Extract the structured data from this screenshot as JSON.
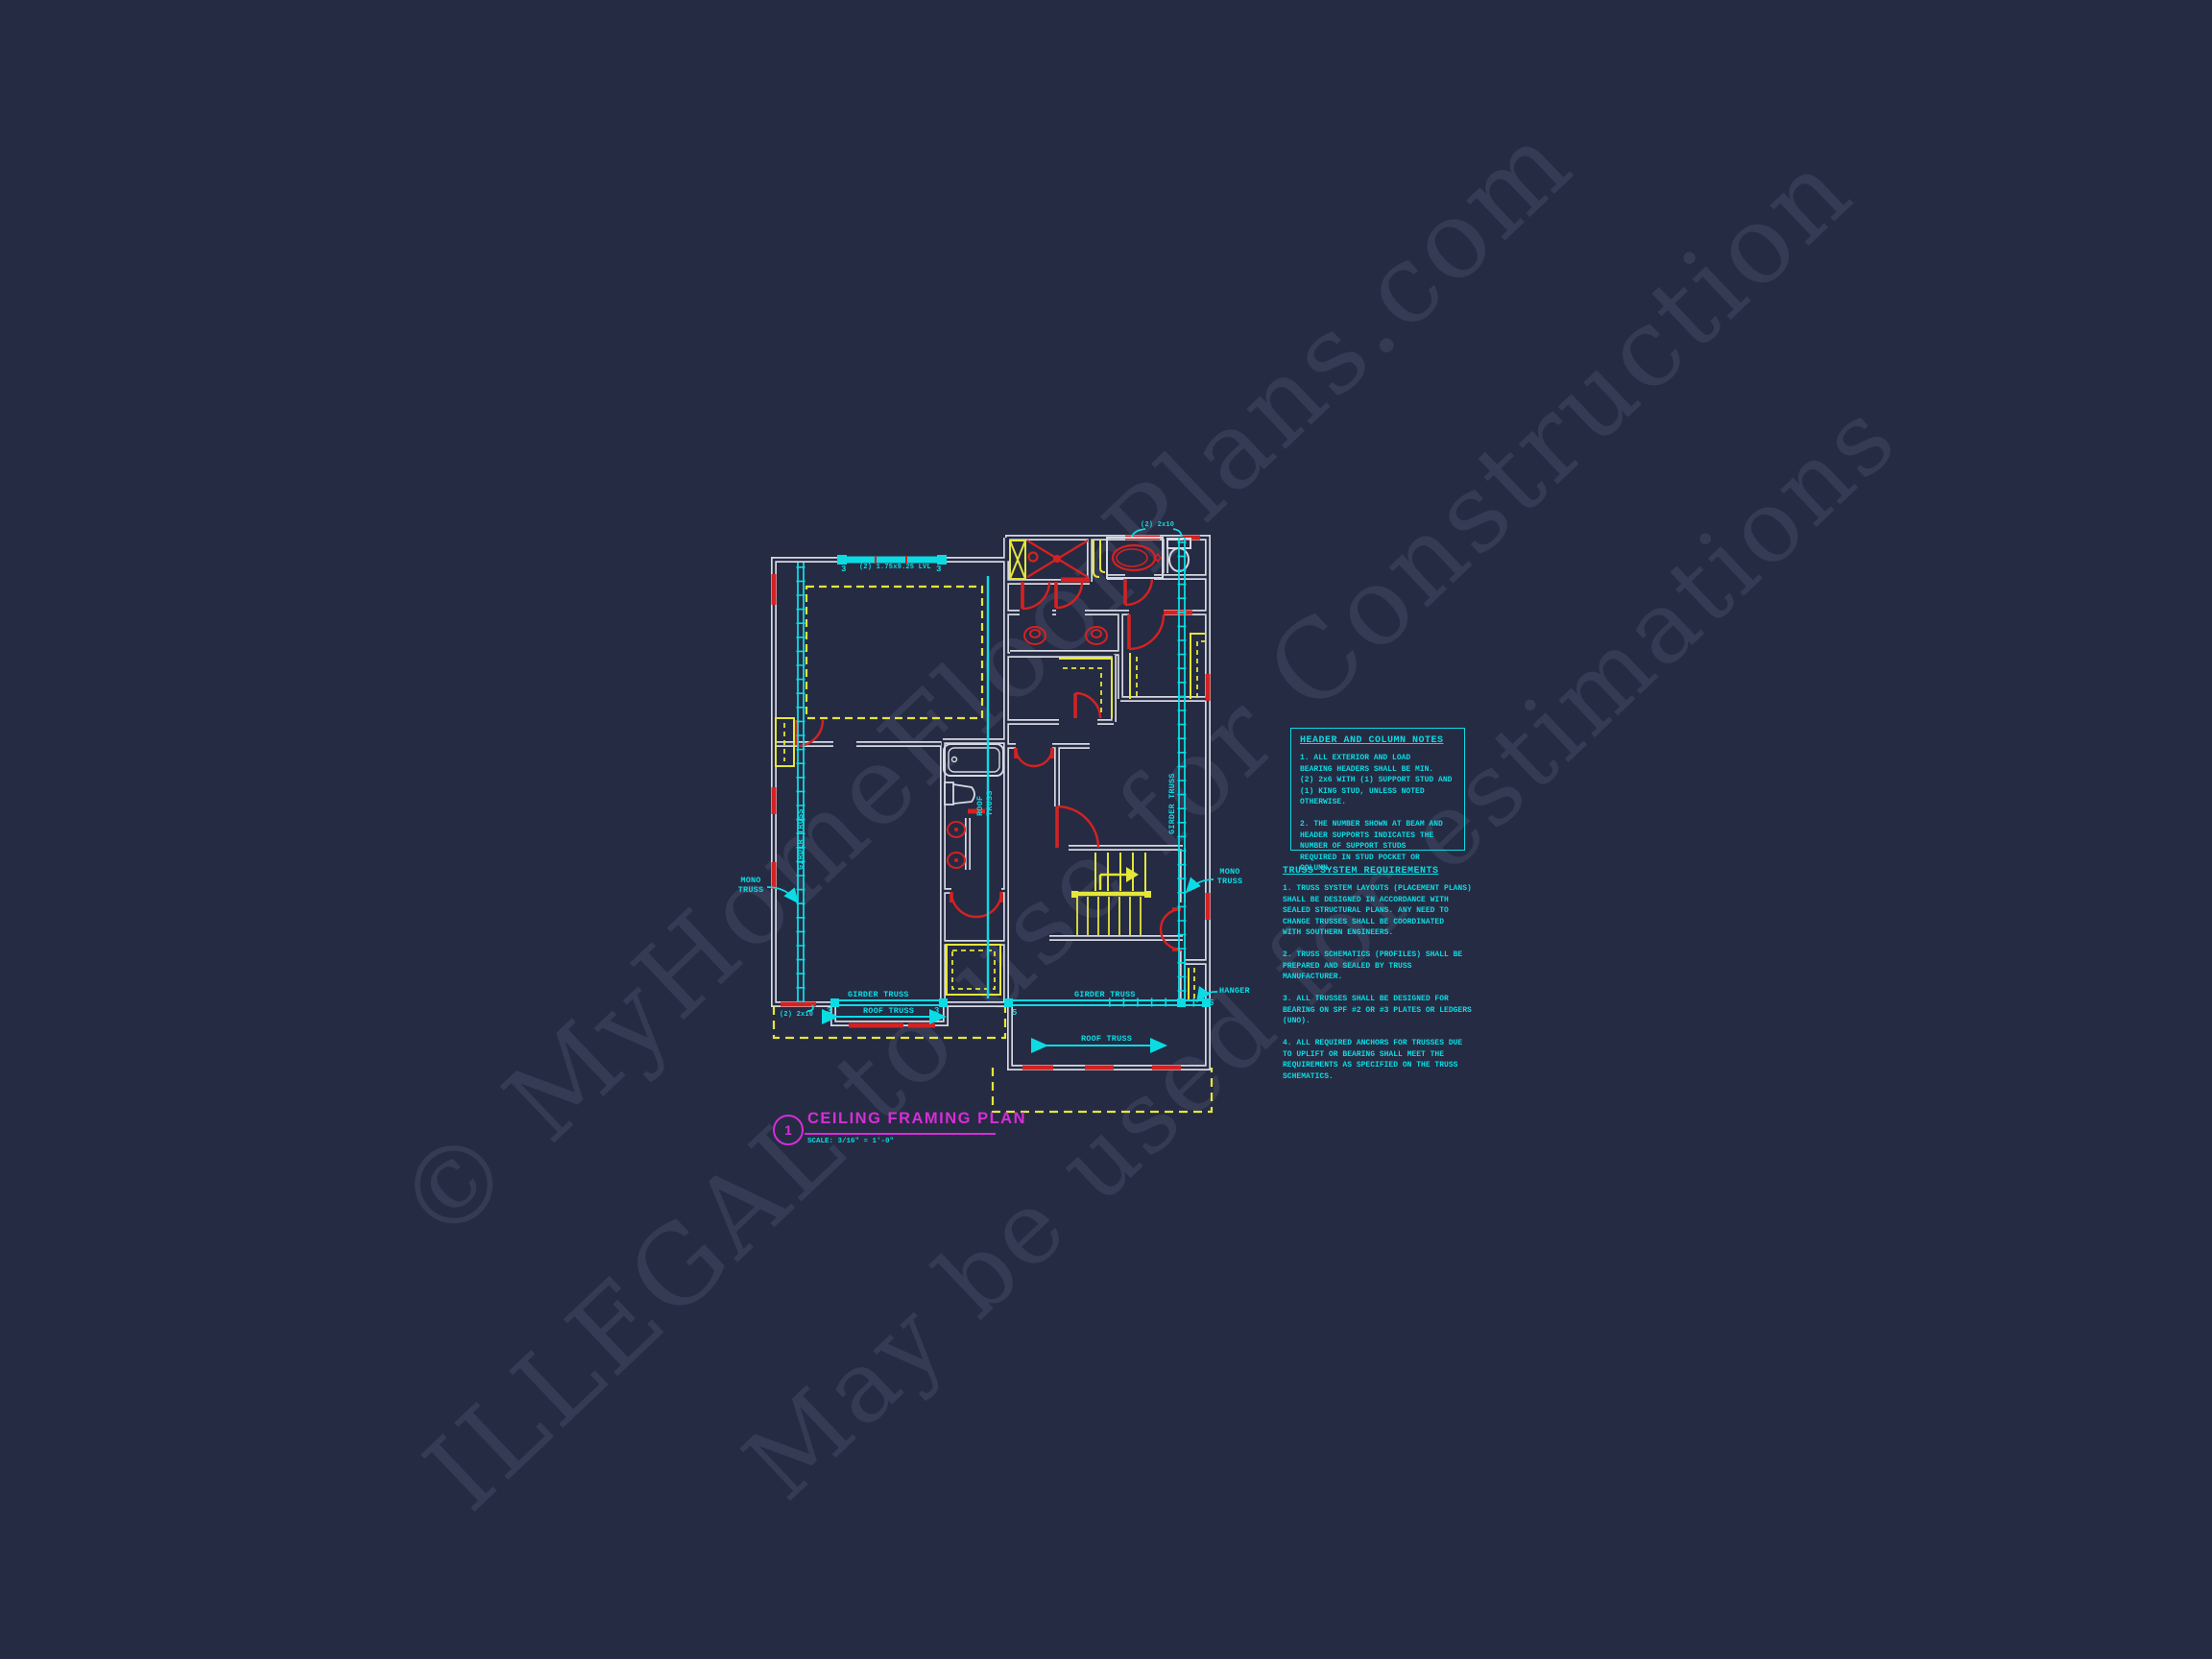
{
  "watermark": {
    "line1": "© MyHomeFloorPlans.com",
    "line2": "ILLEGAL to use for Construction",
    "line3": "May be used for estimations"
  },
  "title_block": {
    "number": "1",
    "title": "CEILING FRAMING PLAN",
    "scale": "SCALE: 3/16\" = 1'-0\""
  },
  "plan_labels": {
    "lvl_beam": "(2) 1.75x9.25 LVL",
    "beam_studs_left": "3",
    "beam_studs_right": "3",
    "header_2x10_top": "(2) 2x10",
    "header_2x10_bottom": "(2) 2x10",
    "girder_truss_left_vertical": "GIRDER TRUSS",
    "girder_truss_right_vertical": "GIRDER TRUSS",
    "roof_truss_vertical": "ROOF\nTRUSS",
    "mono_truss_left": "MONO\nTRUSS",
    "mono_truss_right": "MONO\nTRUSS",
    "hanger": "HANGER",
    "girder_truss_bottom_left": "GIRDER TRUSS",
    "girder_truss_bottom_right": "GIRDER TRUSS",
    "roof_truss_bottom_left": "ROOF TRUSS",
    "roof_truss_bottom_right": "ROOF TRUSS",
    "studs_3_left": "3",
    "studs_3_right": "3",
    "studs_5_left": "5",
    "studs_5_right": "5"
  },
  "notes_header": {
    "title": "HEADER AND COLUMN NOTES",
    "body": "1. ALL EXTERIOR AND LOAD\nBEARING HEADERS SHALL BE MIN.\n(2) 2x6 WITH (1) SUPPORT STUD AND\n(1) KING STUD, UNLESS NOTED\nOTHERWISE.\n\n2. THE NUMBER SHOWN AT BEAM AND\nHEADER SUPPORTS INDICATES THE\nNUMBER OF SUPPORT STUDS\nREQUIRED IN STUD POCKET OR\nCOLUMN."
  },
  "notes_truss": {
    "title": "TRUSS SYSTEM REQUIREMENTS",
    "body": "1. TRUSS SYSTEM LAYOUTS (PLACEMENT PLANS)\nSHALL BE DESIGNED IN ACCORDANCE WITH\nSEALED STRUCTURAL PLANS. ANY NEED TO\nCHANGE TRUSSES SHALL BE COORDINATED\nWITH SOUTHERN ENGINEERS.\n\n2. TRUSS SCHEMATICS (PROFILES) SHALL BE\nPREPARED AND SEALED BY TRUSS\nMANUFACTURER.\n\n3. ALL TRUSSES SHALL BE DESIGNED FOR\nBEARING ON SPF #2 OR #3 PLATES OR LEDGERS\n(UNO).\n\n4. ALL REQUIRED ANCHORS FOR TRUSSES DUE\nTO UPLIFT OR BEARING SHALL MEET THE\nREQUIREMENTS AS SPECIFIED ON THE TRUSS\nSCHEMATICS."
  },
  "colors": {
    "background": "#252b43",
    "annotation_cyan": "#0bdce4",
    "wall_white": "#d7d9e2",
    "door_red": "#d42222",
    "ceiling_yellow": "#e4e63a",
    "title_magenta": "#d62ed6"
  }
}
